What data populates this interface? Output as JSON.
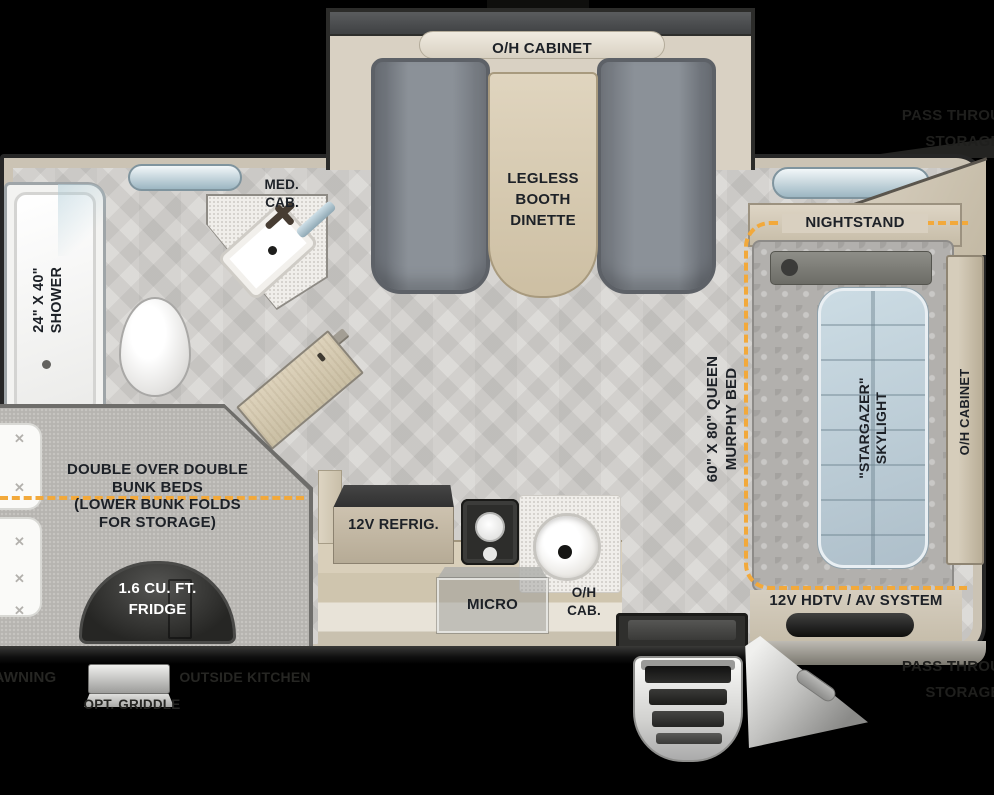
{
  "meta": {
    "type": "travel-trailer-floorplan"
  },
  "colors": {
    "background": "#000000",
    "wall_beige": "#ccc4b5",
    "floor_gray": "#d6d4d1",
    "accent_dash": "#f2a93b",
    "label_text": "#1d2127",
    "seat_gray": "#8b9198",
    "wood": "#d7cab2",
    "skylight_blue": "#bfd2dc",
    "fridge_dark": "#2b2b29"
  },
  "slideout": {
    "cabinet_label": "O/H CABINET",
    "dinette_label": "LEGLESS\nBOOTH\nDINETTE"
  },
  "bathroom": {
    "shower_label": "24\" X 40\"\nSHOWER",
    "med_cab_label": "MED.\nCAB."
  },
  "bunk_area": {
    "bunk_label": "DOUBLE OVER DOUBLE\nBUNK BEDS\n(LOWER BUNK FOLDS\nFOR STORAGE)",
    "fridge_label": "1.6 CU. FT.\nFRIDGE"
  },
  "kitchen": {
    "refrig_label": "12V REFRIG.",
    "micro_label": "MICRO",
    "oh_cab_label": "O/H\nCAB."
  },
  "bedroom": {
    "nightstand_label": "NIGHTSTAND",
    "murphy_bed_label": "60\" X 80\" QUEEN\nMURPHY BED",
    "skylight_label": "\"STARGAZER\"\nSKYLIGHT",
    "av_label": "12V HDTV / AV SYSTEM",
    "oh_cabinet_label": "O/H CABINET"
  },
  "exterior": {
    "awning_label": "AWNING",
    "outside_kitchen_label": "OUTSIDE KITCHEN",
    "griddle_label": "OPT. GRIDDLE",
    "pass_through_top_label": "PASS THROUGH\nSTORAGE",
    "pass_through_bottom_label": "PASS THROUGH\nSTORAGE"
  }
}
